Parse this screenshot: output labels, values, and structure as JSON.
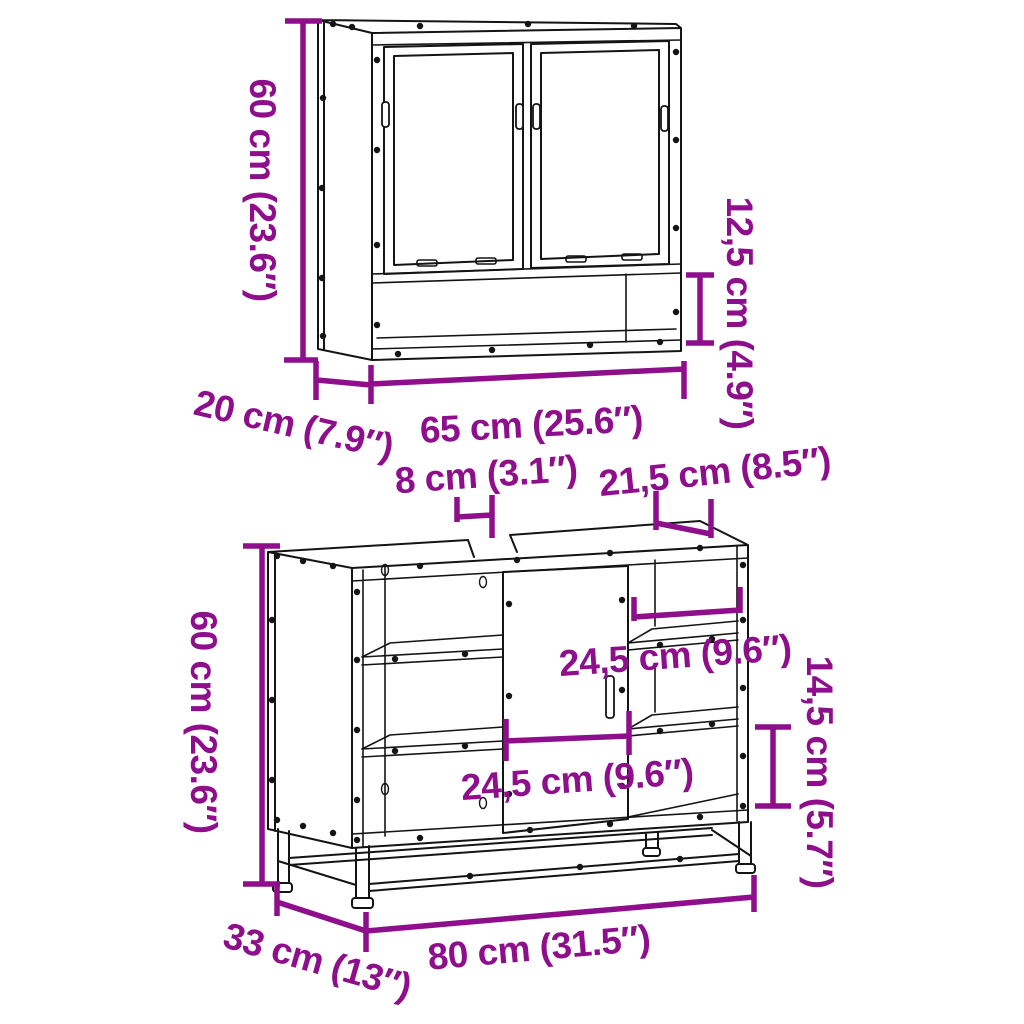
{
  "diagram": {
    "background": "#ffffff",
    "colors": {
      "dimension": "#8E0E8C",
      "line": "#141414"
    },
    "mirror_cabinet": {
      "height": "60 cm (23.6″)",
      "depth": "20 cm (7.9″)",
      "width": "65 cm (25.6″)",
      "open_shelf_height": "12,5 cm (4.9″)"
    },
    "vanity_cabinet": {
      "height": "60 cm (23.6″)",
      "depth": "33 cm (13″)",
      "width": "80 cm (31.5″)",
      "top_cutout_width": "8 cm (3.1″)",
      "top_right_width": "21,5 cm (8.5″)",
      "right_compartment_width": "24,5 cm (9.6″)",
      "door_width": "24,5 cm (9.6″)",
      "right_shelf_spacing": "14,5 cm (5.7″)"
    }
  }
}
